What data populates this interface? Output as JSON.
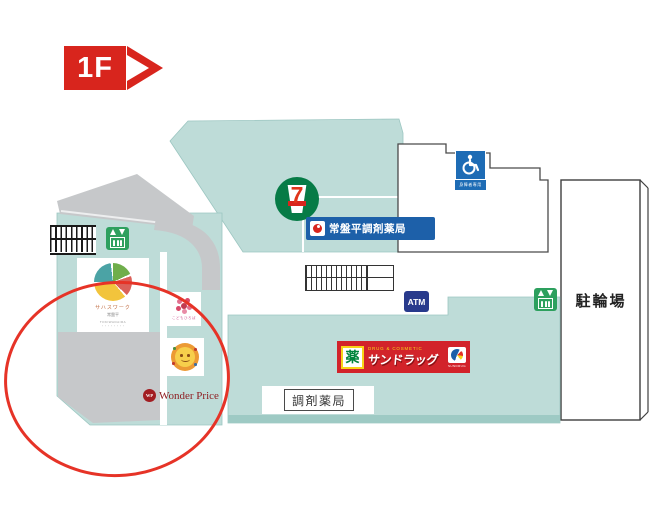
{
  "floor_label": "1F",
  "legend": {
    "bicycle_parking": "駐輪場",
    "dispensing_pharmacy": "調剤薬局",
    "atm": "ATM",
    "accessible_parking_caption": "身障者専用"
  },
  "stores": {
    "seven_eleven": {
      "digit": "7"
    },
    "tokiwadaira_pharmacy": {
      "name": "常盤平調剤薬局"
    },
    "sundrug": {
      "kanji_badge": "薬",
      "tagline": "DRUG & COSMETIC",
      "name": "サンドラッグ",
      "caption": "SUNDRUG"
    },
    "pie_logo_tenant": {
      "line1": "サハスワーク",
      "line2": "常盤平",
      "line3": "TOKIWADAIRA",
      "line4": "・・・・・・・・"
    },
    "flower_logo_tenant": {
      "caption": "こどもひろば"
    },
    "wonder_price": {
      "badge": "WP",
      "name": "Wonder Price"
    }
  },
  "colors": {
    "building_teal": "#BEDCD8",
    "walkway_gray": "#C6C8CA",
    "floor_tag_red": "#D8251D",
    "annotation_red": "#E63327",
    "atm_blue": "#283A8C",
    "pharmacy_blue": "#1D60A9",
    "accessible_blue": "#1E6CB5",
    "elevator_green": "#2DA05E",
    "sundrug_red": "#D2232A"
  }
}
